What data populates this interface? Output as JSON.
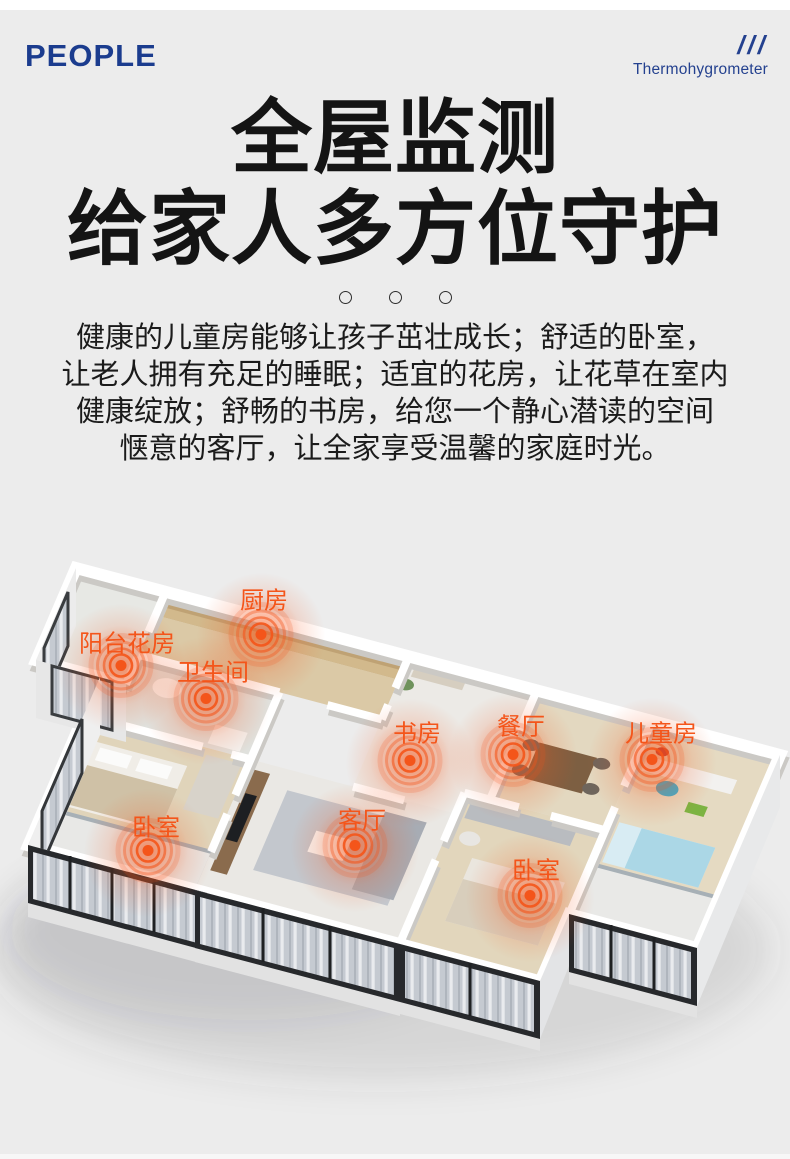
{
  "header": {
    "logo": "PEOPLE",
    "slashes": "///",
    "tagline": "Thermohygrometer"
  },
  "title": {
    "text": "全屋监测\n给家人多方位守护"
  },
  "intro": {
    "text": "健康的儿童房能够让孩子茁壮成长；舒适的卧室，\n让老人拥有充足的睡眠；适宜的花房，让花草在室内\n健康绽放；舒畅的书房，给您一个静心潜读的空间\n惬意的客厅，让全家享受温馨的家庭时光。"
  },
  "colors": {
    "accent": "#f4551a",
    "brand_navy": "#1b3c8e",
    "background": "#ececec"
  },
  "scene": {
    "description": "isometric-apartment-floor-plan",
    "rooms": [
      {
        "label": "厨房",
        "tx": 264,
        "ty": 598,
        "mx": 261,
        "my": 637
      },
      {
        "label": "阳台花房",
        "tx": 127,
        "ty": 641,
        "mx": 121,
        "my": 668
      },
      {
        "label": "卫生间",
        "tx": 213,
        "ty": 670,
        "mx": 206,
        "my": 701
      },
      {
        "label": "书房",
        "tx": 417,
        "ty": 731,
        "mx": 410,
        "my": 763
      },
      {
        "label": "餐厅",
        "tx": 521,
        "ty": 724,
        "mx": 513,
        "my": 757
      },
      {
        "label": "儿童房",
        "tx": 661,
        "ty": 731,
        "mx": 652,
        "my": 762
      },
      {
        "label": "卧室",
        "tx": 156,
        "ty": 825,
        "mx": 148,
        "my": 853
      },
      {
        "label": "客厅",
        "tx": 362,
        "ty": 818,
        "mx": 355,
        "my": 848
      },
      {
        "label": "卧室",
        "tx": 536,
        "ty": 868,
        "mx": 530,
        "my": 898
      }
    ]
  }
}
